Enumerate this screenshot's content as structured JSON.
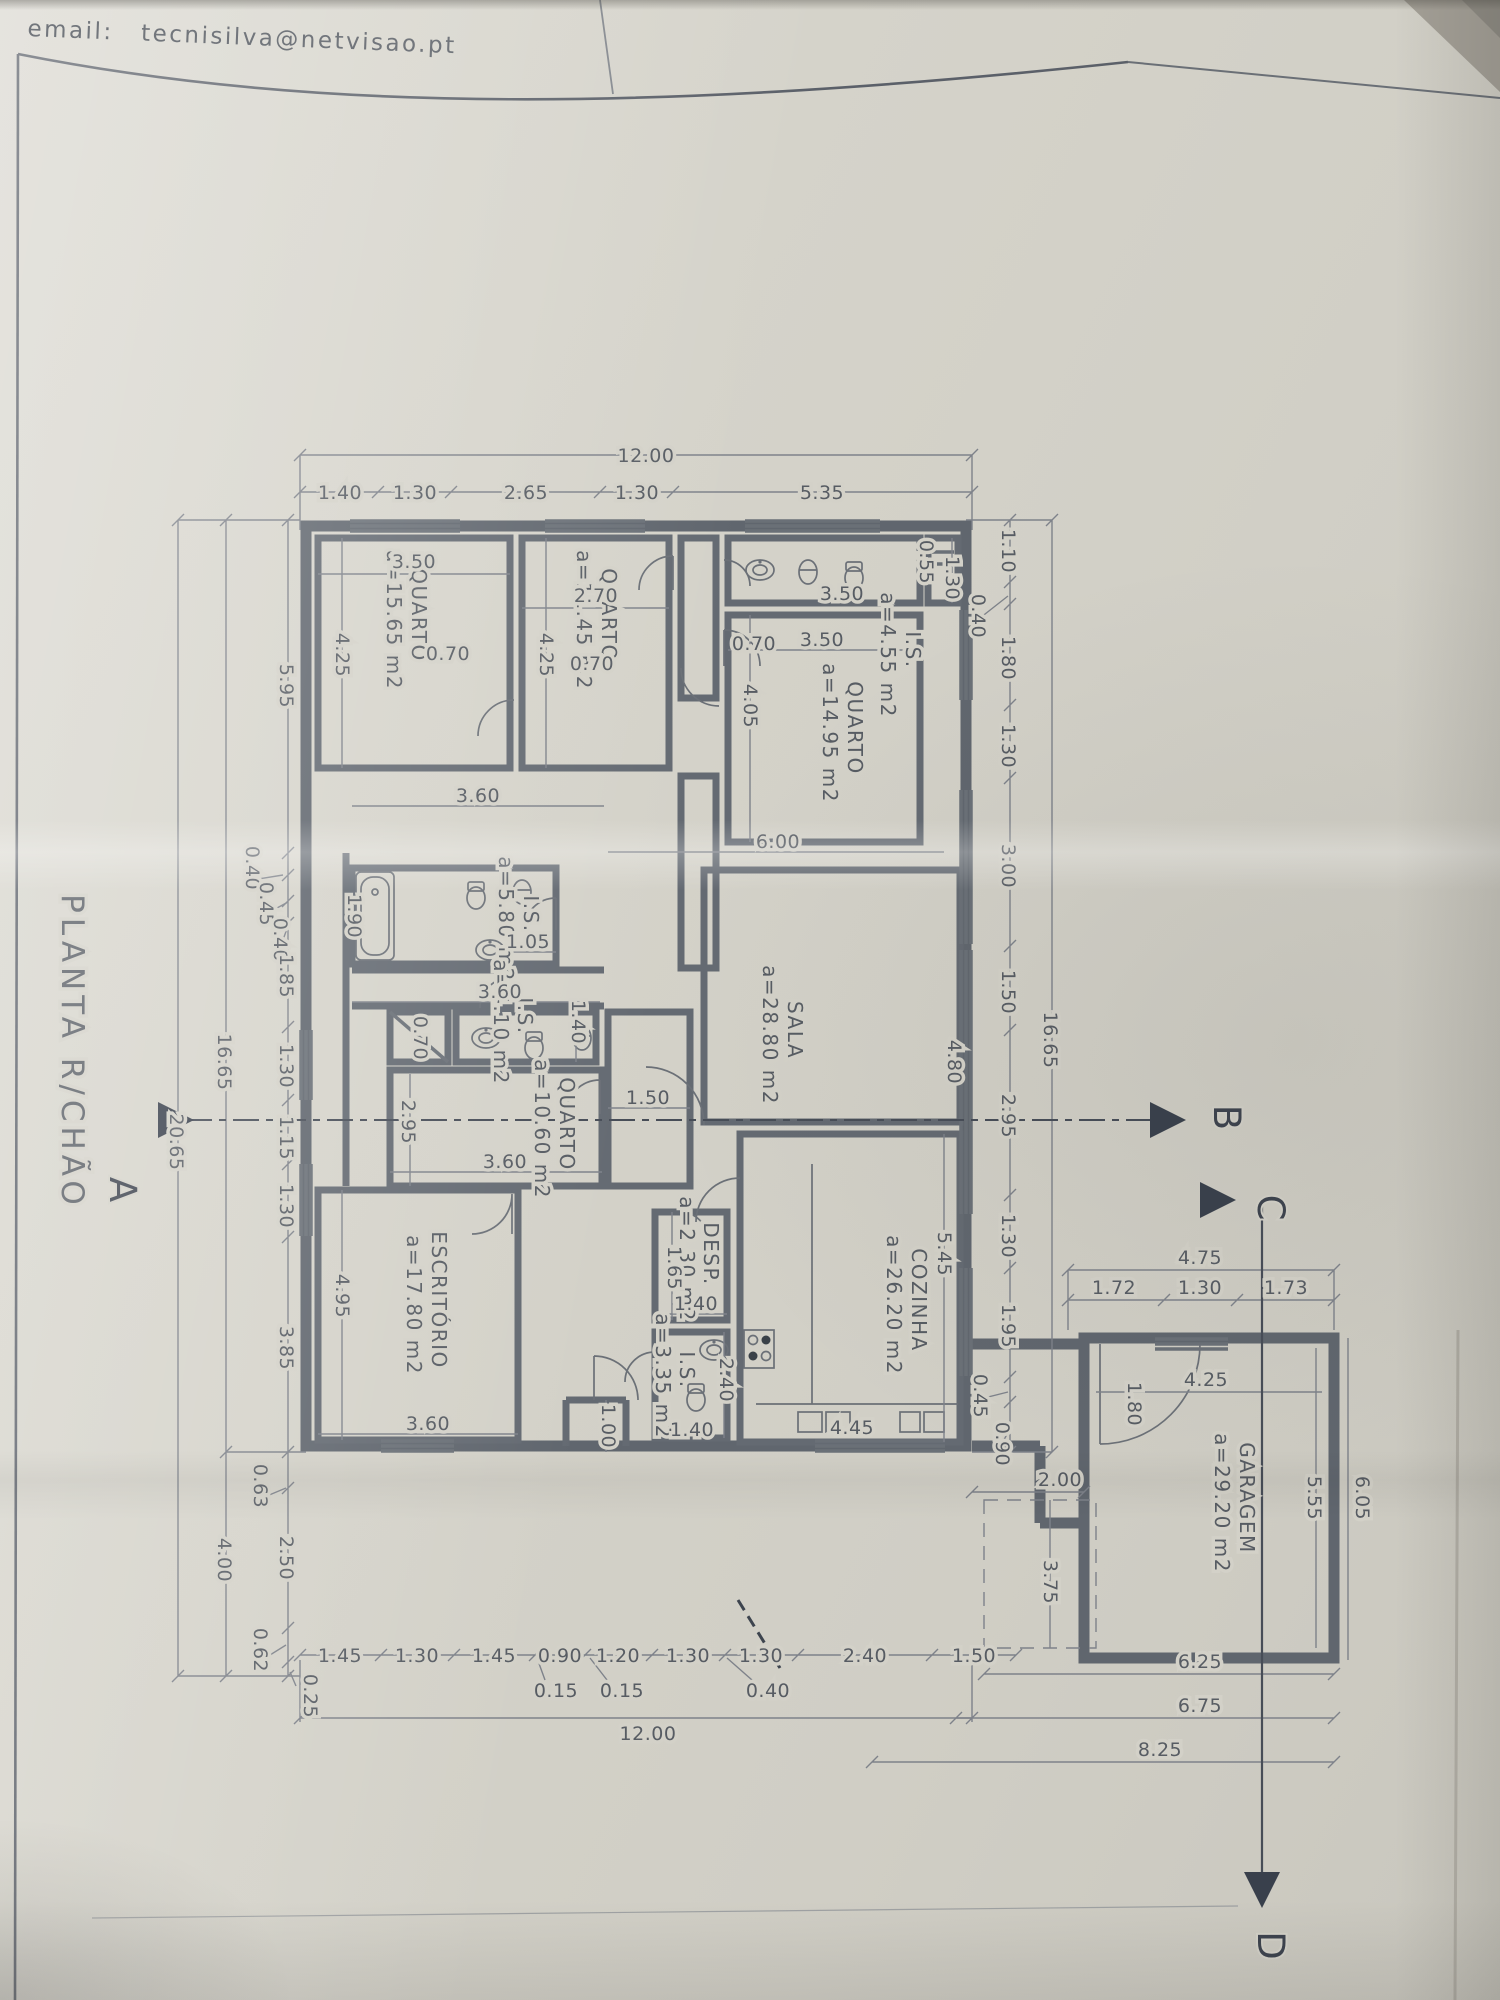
{
  "email": "email:  tecnisilva@netvisao.pt",
  "title": "PLANTA R/CHÃO",
  "rooms": [
    {
      "name": "QUARTO",
      "area": "a=15.65 m2"
    },
    {
      "name": "QUARTO",
      "area": "a=11.45 m2"
    },
    {
      "name": "I.S.",
      "area": "a=4.55 m2"
    },
    {
      "name": "QUARTO",
      "area": "a=14.95 m2"
    },
    {
      "name": "I.S.",
      "area": "a=5.80 m2"
    },
    {
      "name": "I.S.",
      "area": "a=4.10 m2"
    },
    {
      "name": "QUARTO",
      "area": "a=10.60 m2"
    },
    {
      "name": "SALA",
      "area": "a=28.80 m2"
    },
    {
      "name": "ESCRITÓRIO",
      "area": "a=17.80 m2"
    },
    {
      "name": "DESP.",
      "area": "a=2.30 m2"
    },
    {
      "name": "I.S.",
      "area": "a=3.35 m2"
    },
    {
      "name": "COZINHA",
      "area": "a=26.20 m2"
    },
    {
      "name": "GARAGEM",
      "area": "a=29.20 m2"
    }
  ],
  "sections": {
    "a": "A",
    "b": "B",
    "c": "C",
    "d": "D"
  },
  "dims_top": [
    "12.00",
    "1.40",
    "1.30",
    "2.65",
    "1.30",
    "5.35"
  ],
  "dims_bottom": [
    "1.45",
    "1.30",
    "1.45",
    "0.90",
    "1.20",
    "1.30",
    "1.30",
    "2.40",
    "1.50",
    "0.15",
    "0.15",
    "0.40",
    "12.00"
  ],
  "dims_left": [
    "5.95",
    "0.40",
    "0.45",
    "0.40",
    "1.85",
    "1.30",
    "1.15",
    "1.30",
    "3.85",
    "0.63",
    "2.50",
    "0.62",
    "0.25",
    "16.65",
    "4.00",
    "20.65"
  ],
  "dims_right": [
    "1.10",
    "0.40",
    "1.80",
    "1.30",
    "3.00",
    "1.50",
    "2.95",
    "1.30",
    "1.95",
    "0.45",
    "0.90",
    "16.65"
  ],
  "dims_garage": [
    "4.75",
    "1.72",
    "1.30",
    "1.73",
    "4.25",
    "1.80",
    "2.00",
    "3.75",
    "5.55",
    "6.05",
    "6.25",
    "6.75",
    "8.25"
  ],
  "dims_interior": [
    "3.50",
    "4.25",
    "2.70",
    "4.25",
    "0.70",
    "0.70",
    "0.70",
    "3.50",
    "1.30",
    "0.55",
    "3.50",
    "4.05",
    "1.90",
    "1.05",
    "3.60",
    "1.40",
    "0.70",
    "2.95",
    "3.60",
    "1.50",
    "6.00",
    "4.80",
    "4.95",
    "3.60",
    "1.00",
    "1.65",
    "1.40",
    "2.40",
    "1.40",
    "5.45",
    "4.45",
    "3.60"
  ]
}
